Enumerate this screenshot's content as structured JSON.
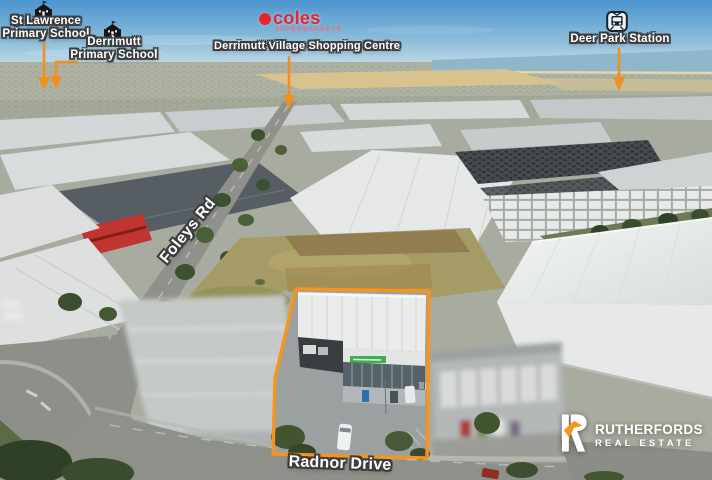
{
  "image_type": "aerial-property-photograph",
  "landmarks": {
    "st_lawrence": {
      "line1": "St Lawrence",
      "line2": "Primary School"
    },
    "derrimutt_school": {
      "line1": "Derrimutt",
      "line2": "Primary School"
    },
    "shopping_centre": {
      "label": "Derrimutt Village Shopping Centre"
    },
    "deer_park": {
      "label": "Deer Park Station"
    }
  },
  "coles": {
    "wordmark": "coles",
    "tagline": "SUPERMARKETS"
  },
  "streets": {
    "foleys": "Foleys Rd",
    "radnor": "Radnor Drive"
  },
  "branding": {
    "name": "RUTHERFORDS",
    "subtitle": "REAL ESTATE"
  },
  "icons": {
    "st_lawrence": "school-icon",
    "derrimutt_school": "school-icon",
    "deer_park": "train-icon",
    "shopping_centre": "coles-logo",
    "brand": "rutherfords-house-icon"
  },
  "colors": {
    "annotation_orange": "#f0911f",
    "boundary_orange": "#f7941d",
    "coles_red": "#e8242c",
    "coles_red_light": "#ef6e76",
    "label_outline": "#3d3d3d",
    "brand_orange": "#f7941d"
  }
}
